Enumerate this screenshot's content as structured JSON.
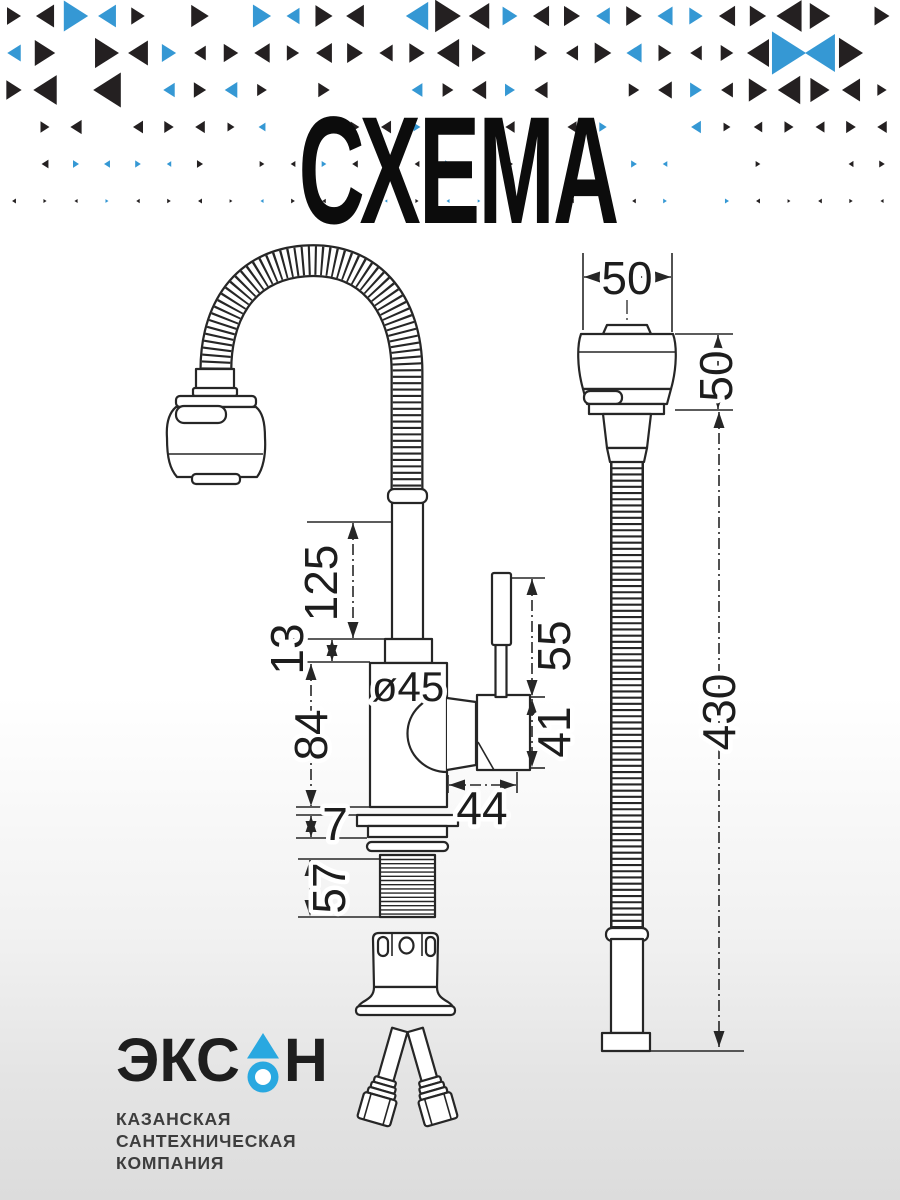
{
  "title": "СХЕМА",
  "drawing": {
    "dims": {
      "head_width": "50",
      "head_height": "50",
      "spout_pipe_height": "125",
      "cap_height": "13",
      "body_diameter": "ø45",
      "body_height": "84",
      "flange_height": "7",
      "thread_length": "57",
      "lever_height": "55",
      "handle_height": "41",
      "handle_length": "44",
      "hose_length": "430"
    }
  },
  "logo": {
    "name_prefix": "ЭКС",
    "name_suffix": "Н",
    "tagline": [
      "КАЗАНСКАЯ",
      "САНТЕХНИЧЕСКАЯ",
      "КОМПАНИЯ"
    ]
  },
  "colors": {
    "pattern_black": "#242021",
    "pattern_blue": "#3598d4",
    "logo_blue": "#29a8e0",
    "line": "#262626"
  }
}
